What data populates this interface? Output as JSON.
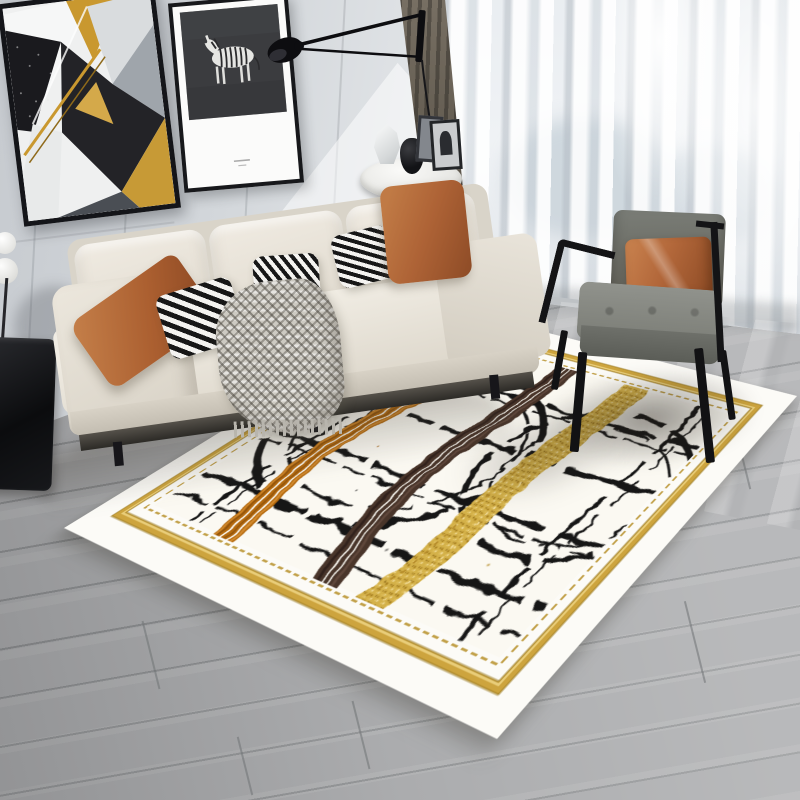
{
  "scene": {
    "description": "Product photograph of a modern living room showcasing an abstract brushstroke area rug with beige sofa, gray armchair, wall art, wall lamp, sheer curtains and gray wood floor",
    "wall": {
      "label": "light gray panelled wall",
      "color": "#d3d7db",
      "sunlight": "bright sunlight patch"
    },
    "artworks": [
      {
        "name": "geometric abstract art",
        "frame_color": "#141519",
        "colors": [
          "#1a1a1e",
          "#eff0f0",
          "#c9982f",
          "#9fa5ab",
          "#232327"
        ]
      },
      {
        "name": "zebra art print",
        "frame_color": "#17181b",
        "background": "#3b3c3f",
        "zebra_color": "#e6e6e3"
      }
    ],
    "wall_lamp": {
      "label": "black swing-arm wall lamp with hanging cord",
      "color": "#0d0d10"
    },
    "curtains": {
      "sheer": "#eef1f4",
      "dark_panel": "#5f584d"
    },
    "sofa": {
      "label": "beige three-seat fabric sofa",
      "fabric_color": "#e9e4da",
      "back_cushions": 3,
      "pillows": [
        {
          "name": "orange lumbar pillow left",
          "color": "#ab5f30"
        },
        {
          "name": "black-white striped pillow",
          "color": "#171717"
        },
        {
          "name": "black-white striped pillow",
          "color": "#171717"
        },
        {
          "name": "black-white striped pillow",
          "color": "#171717"
        },
        {
          "name": "orange square pillow right",
          "color": "#ae6336"
        }
      ],
      "throw": {
        "label": "gray woven knit throw with fringe",
        "color": "#cdcac2"
      }
    },
    "side_table": {
      "label": "round white side table",
      "top_color": "#f0f0ed",
      "decor": [
        "white faceted vase",
        "black vase",
        "picture frame",
        "picture frame with arch motif"
      ]
    },
    "armchair": {
      "label": "gray armchair with black metal frame",
      "fabric_color": "#7a7d77",
      "frame_color": "#141416",
      "pillow_color": "#b2673a"
    },
    "floor": {
      "label": "gray wood plank floor",
      "color": "#a3a4a6",
      "seam_color": "#8c8e90"
    },
    "left_decor": {
      "label": "white ball decor on stand and black glossy cabinet"
    },
    "rug": {
      "label": "abstract brushstroke area rug",
      "outer_margin": "#fcfbf7",
      "gold_border": "#cda43e",
      "stitch_line": "#c2a14a",
      "field": "#fbf9f2",
      "strokes": [
        {
          "name": "black sketch lines and arcs",
          "color": "#191919"
        },
        {
          "name": "orange combed brush stroke",
          "color": "#b4690f"
        },
        {
          "name": "coffee brown brush stroke",
          "color": "#4a352c"
        },
        {
          "name": "gold glitter brush stroke",
          "color": "#d4b14a"
        }
      ]
    }
  },
  "palette": {
    "wall_base": "#d3d7db",
    "wall_dark": "#c6cacf",
    "wall_light": "#edeff1",
    "floor_base": "#a3a4a6",
    "floor_light": "#abacae",
    "floor_seam": "#8c8e90",
    "stripe_black": "#171717",
    "stripe_white": "#f4f3f0",
    "throw_gray": "#cdcac2",
    "chair_frame": "#141416",
    "rug_gold": "#cda43e"
  }
}
